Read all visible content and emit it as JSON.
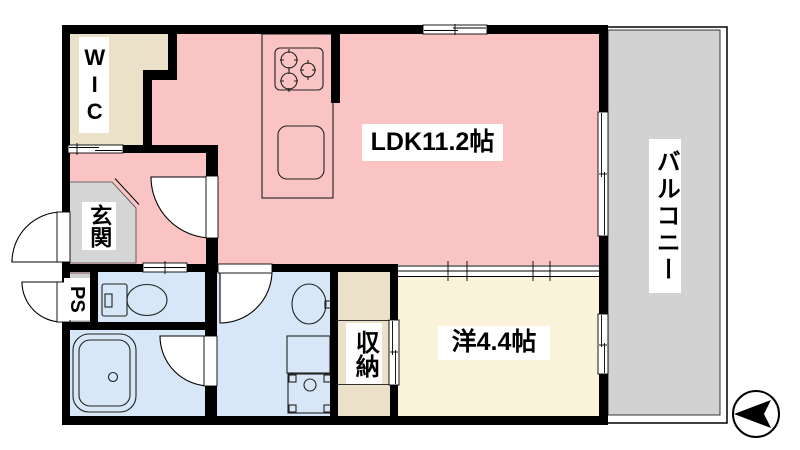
{
  "plan": {
    "type": "japanese-apartment-floor-plan",
    "rooms": {
      "wic": "WIC",
      "ldk": "LDK11.2帖",
      "balcony": "バルコニー",
      "entrance": "玄関",
      "pipe_space": "PS",
      "storage": "収納",
      "western_room": "洋4.4帖"
    },
    "fixtures": [
      "stove-icon",
      "kitchen-sink-icon",
      "toilet-icon",
      "bathtub-icon",
      "washbasin-icon",
      "vanity-cabinet-icon",
      "washing-machine-pan-icon",
      "compass-icon"
    ],
    "colors": {
      "ldk_pink": "#FAC4C4",
      "closet_beige": "#EBE0C8",
      "western_cream": "#FAF2D9",
      "wet_area_blue": "#D7E7F7",
      "entrance_gray": "#D5D5D5",
      "balcony_gray": "#D2D2D2",
      "wall_black": "#000000"
    }
  }
}
